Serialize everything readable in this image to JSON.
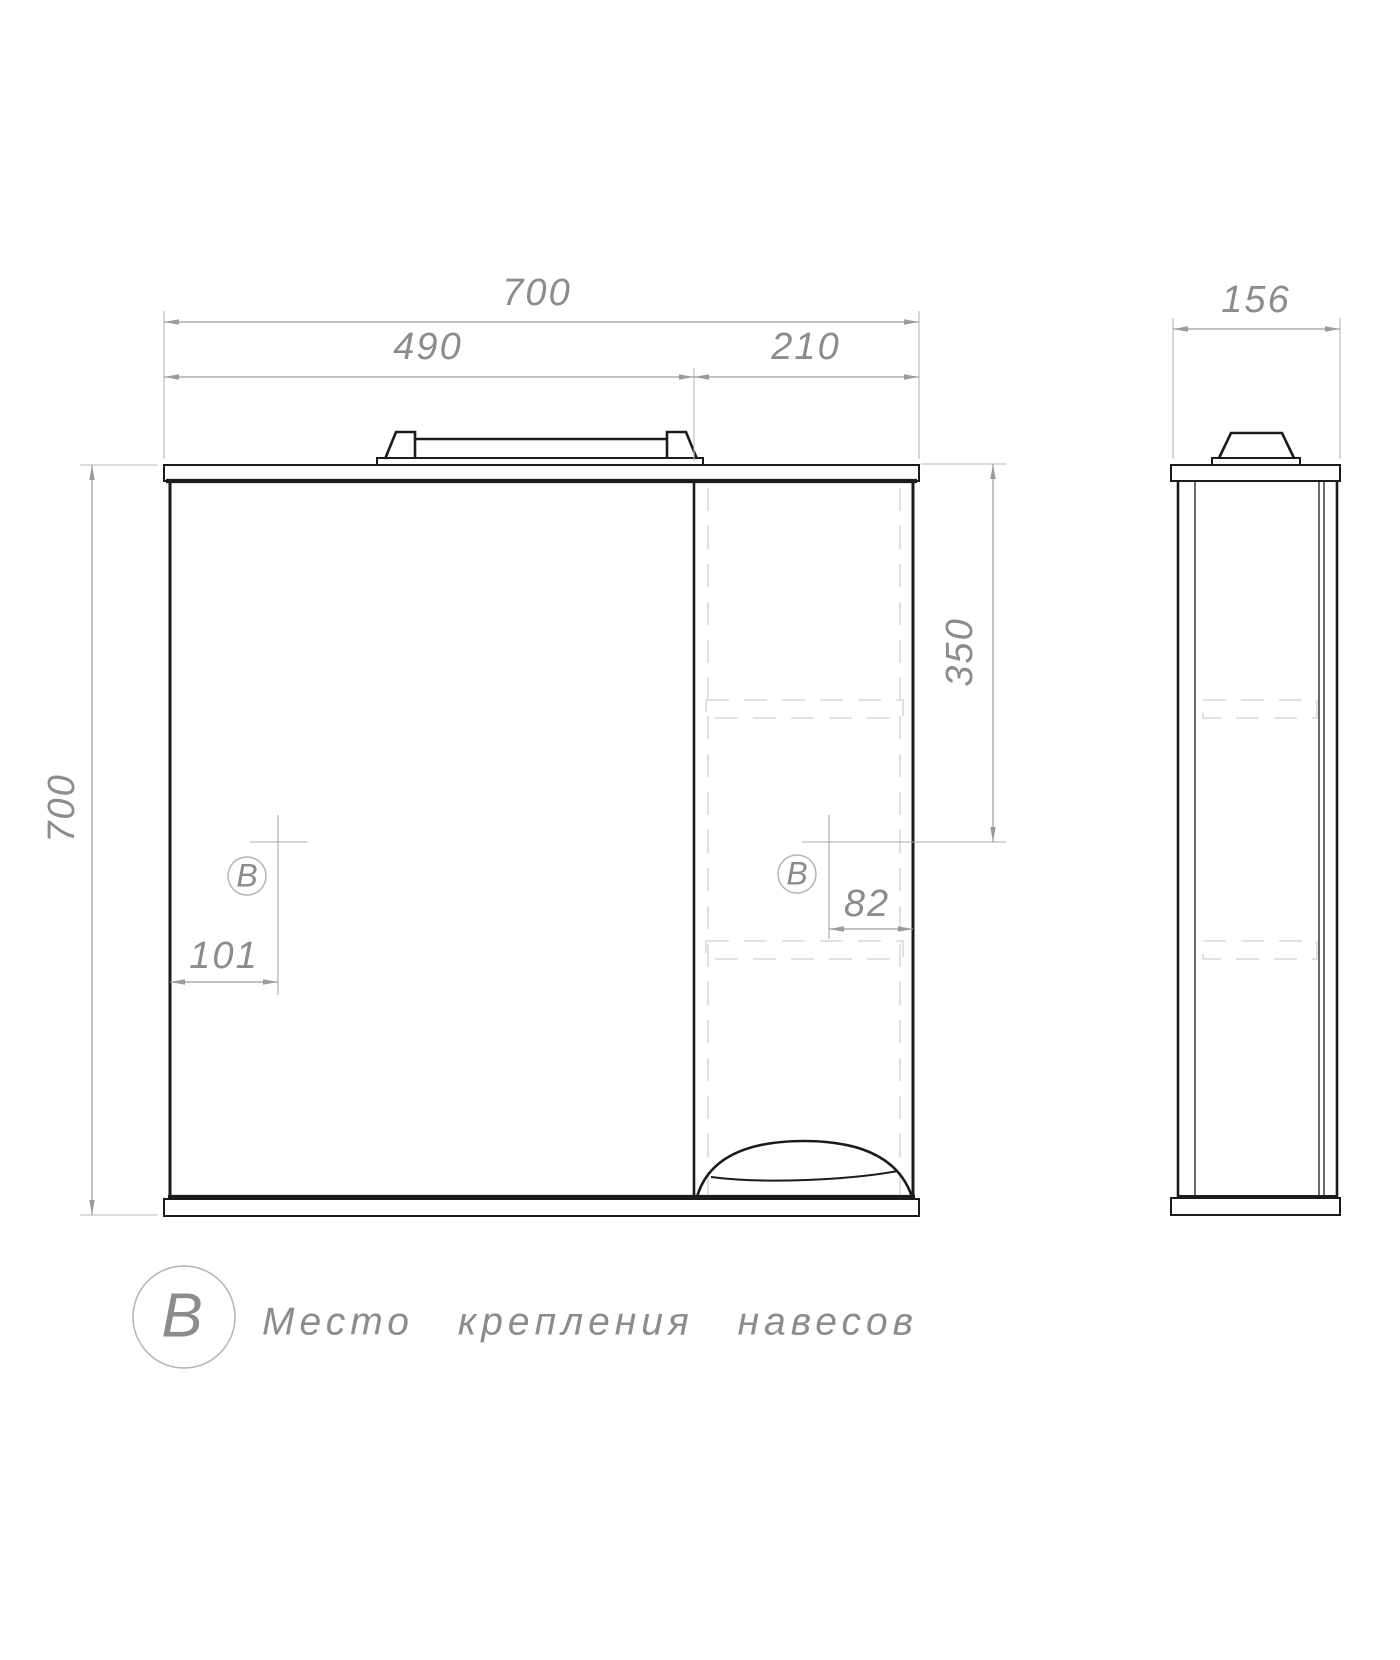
{
  "colors": {
    "outline": "#1b1b1b",
    "dimension": "#9a9a9a",
    "extension": "#b8b8b8",
    "crosshair": "#a8a8a8",
    "dashed": "#d9d9d9",
    "dim_text": "#8c8c8c",
    "marker_ring": "#b4b4b4",
    "background": "#ffffff"
  },
  "front_view": {
    "dim_total_width": "700",
    "dim_mirror_width": "490",
    "dim_right_width": "210",
    "dim_height": "700",
    "dim_mount_top": "350",
    "dim_mount_right": "82",
    "dim_mount_left": "101",
    "marker_left": "B",
    "marker_right": "B"
  },
  "side_view": {
    "dim_depth": "156"
  },
  "legend": {
    "marker": "B",
    "text": "Место крепления навесов"
  }
}
